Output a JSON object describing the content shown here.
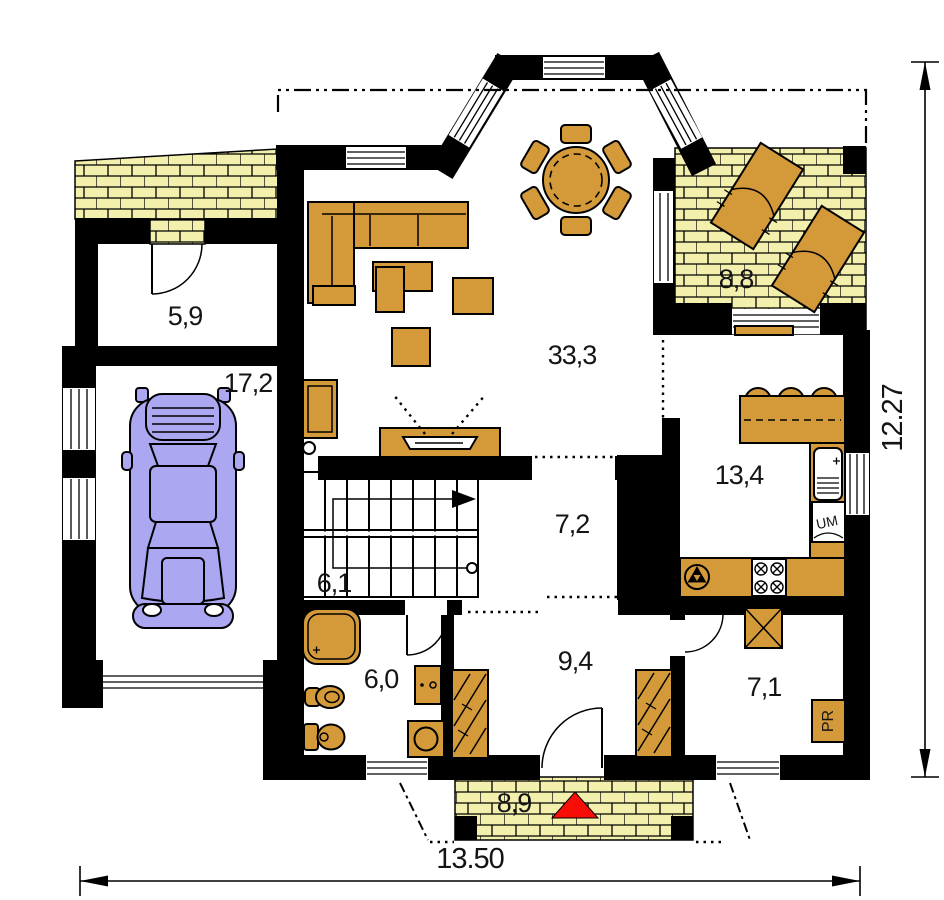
{
  "plan": {
    "rooms": {
      "vestibule": {
        "area": "5,9"
      },
      "garage": {
        "area": "17,2"
      },
      "living_room": {
        "area": "33,3"
      },
      "terrace": {
        "area": "8,8"
      },
      "kitchen": {
        "area": "13,4"
      },
      "hall": {
        "area": "7,2"
      },
      "stair_hall": {
        "area": "6,1"
      },
      "bathroom": {
        "area": "6,0"
      },
      "entry_hall": {
        "area": "9,4"
      },
      "utility_room": {
        "area": "7,1"
      },
      "porch": {
        "area": "8,9"
      }
    },
    "overall_dimensions": {
      "width": "13.50",
      "height": "12.27"
    },
    "appliance_labels": {
      "dishwasher": "UM",
      "pantry": "PR"
    },
    "colors": {
      "furniture": "#D49A3A",
      "brick": "#F2F0AC",
      "car": "#ABA7F0",
      "accent_red": "#F80D07",
      "wall": "#000000"
    }
  }
}
